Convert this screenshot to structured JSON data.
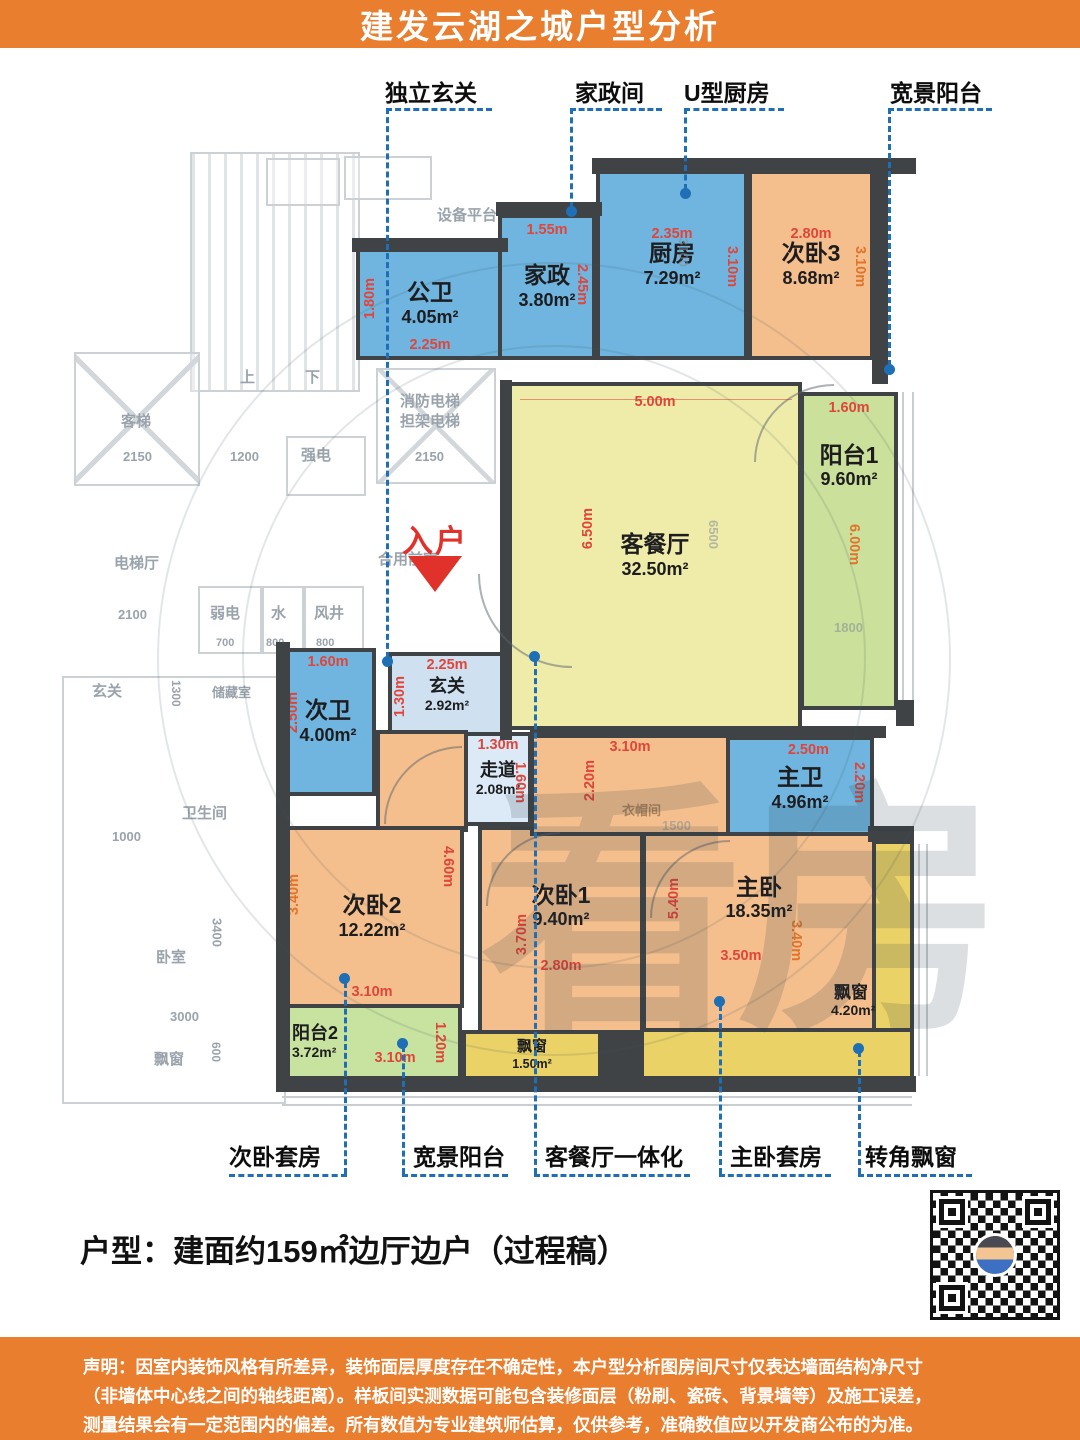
{
  "title": "建发云湖之城户型分析",
  "callouts_top": [
    {
      "label": "独立玄关"
    },
    {
      "label": "家政间"
    },
    {
      "label": "U型厨房"
    },
    {
      "label": "宽景阳台"
    }
  ],
  "callouts_bottom": [
    {
      "label": "次卧套房"
    },
    {
      "label": "宽景阳台"
    },
    {
      "label": "客餐厅一体化"
    },
    {
      "label": "主卧套房"
    },
    {
      "label": "转角飘窗"
    }
  ],
  "entry": {
    "label": "入户"
  },
  "watermark": "看房",
  "rooms": [
    {
      "name": "公卫",
      "area": "4.05m²",
      "dims": [
        "1.80m",
        "2.25m"
      ]
    },
    {
      "name": "家政",
      "area": "3.80m²",
      "dims": [
        "1.55m",
        "2.45m"
      ]
    },
    {
      "name": "厨房",
      "area": "7.29m²",
      "dims": [
        "2.35m",
        "3.10m"
      ]
    },
    {
      "name": "次卧3",
      "area": "8.68m²",
      "dims": [
        "2.80m",
        "3.10m"
      ]
    },
    {
      "name": "阳台1",
      "area": "9.60m²",
      "dims": [
        "1.60m",
        "6.00m"
      ]
    },
    {
      "name": "客餐厅",
      "area": "32.50m²",
      "dims": [
        "5.00m",
        "6.50m"
      ]
    },
    {
      "name": "玄关",
      "area": "2.92m²",
      "dims": [
        "2.25m",
        "1.30m"
      ]
    },
    {
      "name": "次卫",
      "area": "4.00m²",
      "dims": [
        "1.60m",
        "2.50m"
      ]
    },
    {
      "name": "走道",
      "area": "2.08m²",
      "dims": [
        "1.30m",
        "1.60m"
      ]
    },
    {
      "name": "主卫",
      "area": "4.96m²",
      "dims": [
        "2.50m",
        "2.20m"
      ]
    },
    {
      "name": "次卧2",
      "area": "12.22m²",
      "dims": [
        "3.40m",
        "4.60m",
        "3.10m"
      ]
    },
    {
      "name": "阳台2",
      "area": "3.72m²",
      "dims": [
        "3.10m",
        "1.20m"
      ]
    },
    {
      "name": "次卧1",
      "area": "9.40m²",
      "dims": [
        "3.70m",
        "2.80m"
      ]
    },
    {
      "name": "主卧",
      "area": "18.35m²",
      "dims": [
        "3.10m",
        "2.20m",
        "5.40m",
        "3.50m",
        "3.40m"
      ]
    },
    {
      "name": "飘窗",
      "area": "1.50m²",
      "dims": []
    },
    {
      "name": "飘窗",
      "area": "4.20m²",
      "dims": []
    },
    {
      "name": "衣帽间"
    }
  ],
  "bg": [
    "设备平台",
    "上",
    "下",
    "客梯",
    "2150",
    "1200",
    "强电",
    "消防电梯\n担架电梯",
    "2150",
    "电梯厅",
    "2100",
    "弱电",
    "700",
    "水",
    "800",
    "风井",
    "800",
    "合用前室",
    "玄关",
    "1300",
    "储藏室",
    "卫生间",
    "1000",
    "卧室",
    "3400",
    "3000",
    "飘窗",
    "600"
  ],
  "bgnums": [
    "6500",
    "1500",
    "1800",
    "3100"
  ],
  "summary": "户型：建面约159㎡边厅边户（过程稿）",
  "disclaimer": {
    "line1": "声明：因室内装饰风格有所差异，装饰面层厚度存在不确定性，本户型分析图房间尺寸仅表达墙面结构净尺寸",
    "line2": "（非墙体中心线之间的轴线距离）。样板间实测数据可能包含装修面层（粉刷、瓷砖、背景墙等）及施工误差，",
    "line3": "测量结果会有一定范围内的偏差。所有数值为专业建筑师估算，仅供参考，准确数值应以开发商公布的为准。"
  },
  "colors": {
    "brand_orange": "#E87E2E",
    "wall": "#3F4346",
    "wet_blue": "#6FB5DF",
    "hall_blue": "#CFE1F0",
    "living_yellow": "#EFEBA9",
    "bedroom_orange": "#F4BF8D",
    "balcony_green": "#CBE09A",
    "bay_yellow": "#EAD266",
    "dim_red": "#E0453A",
    "dim_orange": "#E0742C",
    "callout_blue": "#1E6FB5",
    "entry_red": "#E0322A"
  }
}
